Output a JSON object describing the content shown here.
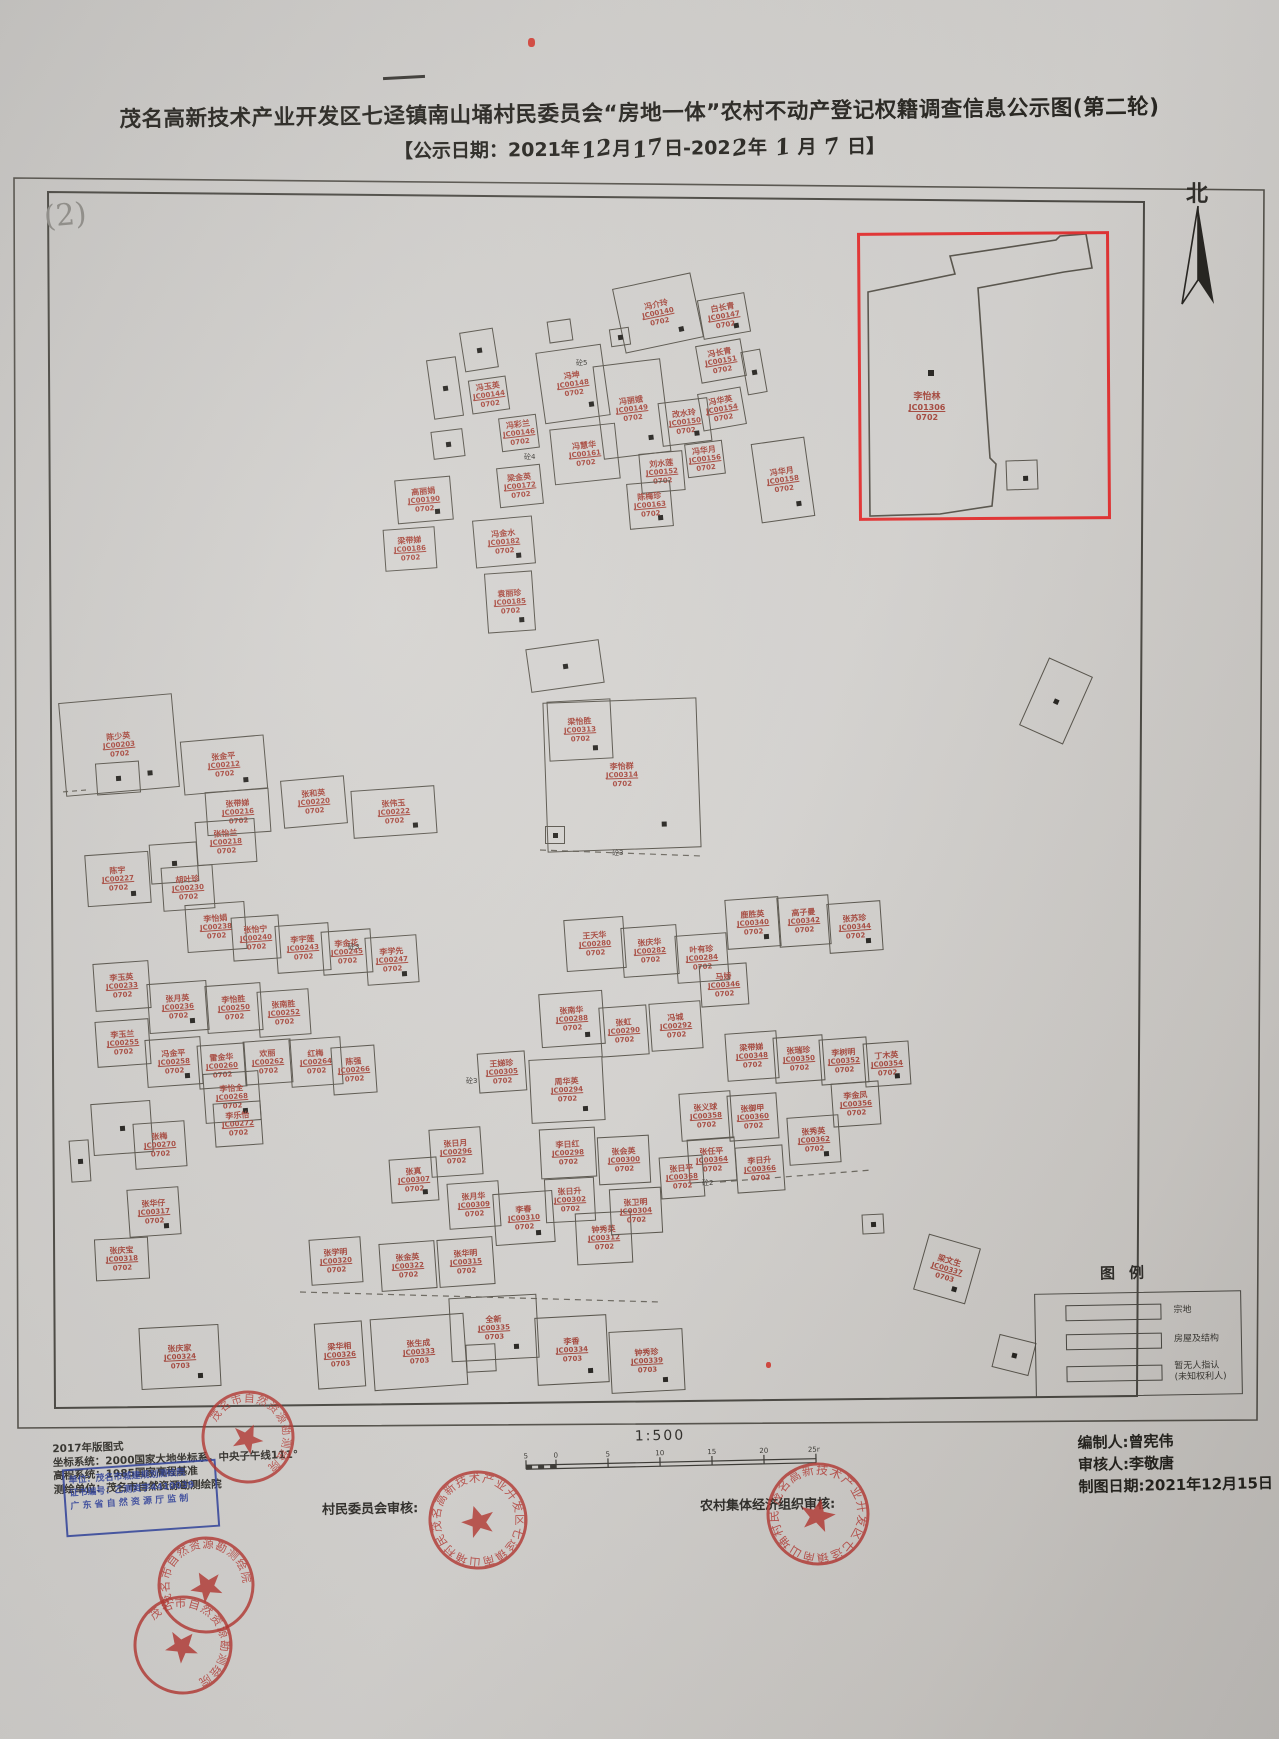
{
  "colors": {
    "paper": "#d2d0cd",
    "line_ink": "#514e47",
    "parcel_label_red": "#a8473c",
    "highlight_red": "#e83030",
    "stamp_red": "#b8342e",
    "stamp_blue": "#2c3f9e"
  },
  "title": {
    "line1": "茂名高新技术产业开发区七迳镇南山埇村民委员会“房地一体”农村不动产登记权籍调查信息公示图(第二轮)",
    "line2_parts": [
      {
        "t": "【公示日期：2021年"
      },
      {
        "t": "12",
        "hand": true
      },
      {
        "t": "月"
      },
      {
        "t": "17",
        "hand": true
      },
      {
        "t": "日-202"
      },
      {
        "t": "2",
        "hand": true
      },
      {
        "t": "年 "
      },
      {
        "t": "1",
        "hand": true
      },
      {
        "t": " 月 "
      },
      {
        "t": "7",
        "hand": true
      },
      {
        "t": " 日】"
      }
    ]
  },
  "annotations": {
    "page_number": "(2)",
    "north_label": "北",
    "sheet_marks": "handwritten dash and small red ink dots"
  },
  "legend": {
    "title": "图例",
    "items": [
      {
        "label": "宗地"
      },
      {
        "label": "房屋及结构"
      },
      {
        "label": "暂无人指认",
        "label2": "(未知权利人)"
      }
    ]
  },
  "scale": {
    "ratio": "1:500",
    "ticks": [
      "5",
      "0",
      "5",
      "10",
      "15",
      "20",
      "25m"
    ]
  },
  "footer": {
    "left_lines": [
      "2017年版图式",
      "坐标系统：2000国家大地坐标系，中央子午线111°",
      "高程系统：1985国家高程基准",
      "测绘单位：茂名市自然资源勘测绘院"
    ],
    "blue_stamp_lines": [
      "单位：茂名市城建规划测绘院",
      "证书编号：乙测资字4410039",
      "广 东 省 自 然 资 源 厅 监 制"
    ],
    "village_review_label": "村民委员会审核:",
    "collective_review_label": "农村集体经济组织审核:",
    "right_lines": [
      "编制人:曾宪伟",
      "审核人:李敬唐",
      "制图日期:2021年12月15日"
    ]
  },
  "stamps": [
    {
      "cx": 478,
      "cy": 1520,
      "r": 48,
      "rot": -18,
      "ring": "茂名高新技术产业开发区七迳镇南山埇村民委员会"
    },
    {
      "cx": 818,
      "cy": 1514,
      "r": 50,
      "rot": 12,
      "ring": "茂名高新技术产业开发区七迳镇南山埇村民委员会"
    },
    {
      "cx": 248,
      "cy": 1437,
      "r": 45,
      "rot": 25,
      "ring": "茂名市自然资源勘测绘院"
    },
    {
      "cx": 206,
      "cy": 1585,
      "r": 47,
      "rot": -30,
      "ring": "茂名市自然资源勘测绘院"
    },
    {
      "cx": 183,
      "cy": 1645,
      "r": 48,
      "rot": 40,
      "ring": "茂名市自然资源勘测绘院"
    }
  ],
  "map": {
    "buildings_format": "x,y,w,h,rotate_deg,owner_name,parcel_code,area_code,door_dot",
    "buildings": [
      [
        618,
        280,
        78,
        64,
        -12,
        "冯介玲",
        "JC00140",
        "0702",
        1
      ],
      [
        700,
        296,
        46,
        38,
        -10,
        "白长青",
        "JC00147",
        "0702",
        1
      ],
      [
        698,
        342,
        44,
        36,
        -10,
        "冯长青",
        "JC00151",
        "0702",
        0
      ],
      [
        744,
        350,
        18,
        42,
        -10,
        "",
        "",
        "",
        1
      ],
      [
        540,
        348,
        64,
        70,
        -8,
        "冯坤",
        "JC00148",
        "0702",
        1
      ],
      [
        598,
        362,
        66,
        92,
        -7,
        "冯丽娥",
        "JC00149",
        "0702",
        1
      ],
      [
        660,
        400,
        48,
        42,
        -7,
        "改水玲",
        "JC00150",
        "0702",
        1
      ],
      [
        552,
        426,
        64,
        54,
        -6,
        "冯慧华",
        "JC00161",
        "0702",
        0
      ],
      [
        640,
        452,
        42,
        38,
        -5,
        "刘水莲",
        "JC00152",
        "0702",
        0
      ],
      [
        700,
        390,
        42,
        36,
        -10,
        "冯华英",
        "JC00154",
        "0702",
        0
      ],
      [
        686,
        442,
        36,
        32,
        -7,
        "冯华月",
        "JC00156",
        "0702",
        0
      ],
      [
        628,
        482,
        42,
        44,
        -5,
        "陈梅珍",
        "JC00163",
        "0702",
        1
      ],
      [
        498,
        466,
        42,
        38,
        -6,
        "梁金英",
        "JC00172",
        "0702",
        0
      ],
      [
        396,
        478,
        54,
        42,
        -5,
        "高丽娟",
        "JC00190",
        "0702",
        1
      ],
      [
        474,
        518,
        58,
        46,
        -5,
        "冯金水",
        "JC00182",
        "0702",
        1
      ],
      [
        384,
        528,
        50,
        40,
        -4,
        "梁带娣",
        "JC00186",
        "0702",
        0
      ],
      [
        486,
        572,
        46,
        58,
        -4,
        "袁丽珍",
        "JC00185",
        "0702",
        1
      ],
      [
        430,
        358,
        28,
        58,
        -8,
        "",
        "",
        "",
        1
      ],
      [
        462,
        330,
        32,
        38,
        -9,
        "",
        "",
        "",
        1
      ],
      [
        470,
        378,
        36,
        32,
        -8,
        "冯玉英",
        "JC00144",
        "0702",
        0
      ],
      [
        432,
        430,
        30,
        26,
        -7,
        "",
        "",
        "",
        1
      ],
      [
        500,
        416,
        36,
        32,
        -7,
        "冯彩兰",
        "JC00146",
        "0702",
        0
      ],
      [
        548,
        320,
        22,
        20,
        -8,
        "",
        "",
        "",
        0
      ],
      [
        610,
        328,
        18,
        16,
        -8,
        "",
        "",
        "",
        1
      ],
      [
        756,
        440,
        52,
        78,
        -8,
        "冯华月",
        "JC00158",
        "0702",
        1
      ],
      [
        1032,
        664,
        46,
        72,
        24,
        "",
        "",
        "",
        1
      ],
      [
        545,
        700,
        152,
        148,
        -2,
        "李怡群",
        "JC00314",
        "0702",
        1
      ],
      [
        548,
        700,
        62,
        58,
        -3,
        "梁怡胜",
        "JC00313",
        "0702",
        1
      ],
      [
        545,
        826,
        18,
        16,
        0,
        "",
        "",
        "",
        1
      ],
      [
        528,
        644,
        72,
        42,
        -8,
        "",
        "",
        "",
        1
      ],
      [
        62,
        698,
        112,
        92,
        -5,
        "陈少英",
        "JC00203",
        "0702",
        1
      ],
      [
        96,
        762,
        42,
        30,
        -4,
        "",
        "",
        "",
        1
      ],
      [
        182,
        738,
        82,
        52,
        -5,
        "张金平",
        "JC00212",
        "0702",
        1
      ],
      [
        206,
        790,
        62,
        42,
        -4,
        "张带娣",
        "JC00216",
        "0702",
        0
      ],
      [
        282,
        778,
        62,
        46,
        -5,
        "张和英",
        "JC00220",
        "0702",
        0
      ],
      [
        352,
        788,
        82,
        46,
        -4,
        "张伟玉",
        "JC00222",
        "0702",
        1
      ],
      [
        196,
        820,
        58,
        42,
        -4,
        "张怡兰",
        "JC00218",
        "0702",
        0
      ],
      [
        150,
        843,
        46,
        38,
        -4,
        "",
        "",
        "",
        1
      ],
      [
        86,
        853,
        62,
        50,
        -4,
        "陈宇",
        "JC00227",
        "0702",
        1
      ],
      [
        162,
        866,
        50,
        42,
        -4,
        "胡叶珍",
        "JC00230",
        "0702",
        0
      ],
      [
        186,
        903,
        58,
        46,
        -4,
        "李怡娟",
        "JC00238",
        "0702",
        0
      ],
      [
        232,
        916,
        46,
        42,
        -4,
        "张怡宁",
        "JC00240",
        "0702",
        0
      ],
      [
        276,
        924,
        52,
        46,
        -4,
        "李宇莲",
        "JC00243",
        "0702",
        0
      ],
      [
        322,
        930,
        48,
        42,
        -4,
        "李金花",
        "JC00245",
        "0702",
        0
      ],
      [
        366,
        936,
        50,
        46,
        -4,
        "李学先",
        "JC00247",
        "0702",
        1
      ],
      [
        94,
        962,
        54,
        46,
        -4,
        "李玉英",
        "JC00233",
        "0702",
        0
      ],
      [
        148,
        982,
        58,
        48,
        -4,
        "张月英",
        "JC00236",
        "0702",
        1
      ],
      [
        206,
        984,
        54,
        46,
        -4,
        "李怡胜",
        "JC00250",
        "0702",
        0
      ],
      [
        258,
        990,
        50,
        44,
        -4,
        "张南胜",
        "JC00252",
        "0702",
        0
      ],
      [
        96,
        1020,
        52,
        44,
        -4,
        "李玉兰",
        "JC00255",
        "0702",
        0
      ],
      [
        146,
        1038,
        54,
        46,
        -4,
        "冯金平",
        "JC00258",
        "0702",
        1
      ],
      [
        198,
        1044,
        46,
        42,
        -4,
        "雷金华",
        "JC00260",
        "0702",
        0
      ],
      [
        244,
        1040,
        46,
        42,
        -4,
        "欢丽",
        "JC00262",
        "0702",
        0
      ],
      [
        290,
        1038,
        50,
        46,
        -4,
        "红梅",
        "JC00264",
        "0702",
        0
      ],
      [
        332,
        1046,
        42,
        46,
        -4,
        "陈强",
        "JC00266",
        "0702",
        0
      ],
      [
        204,
        1072,
        54,
        48,
        -4,
        "李怡全",
        "JC00268",
        "0702",
        1
      ],
      [
        92,
        1102,
        58,
        50,
        -4,
        "",
        "",
        "",
        1
      ],
      [
        70,
        1140,
        18,
        40,
        -4,
        "",
        "",
        "",
        1
      ],
      [
        134,
        1122,
        50,
        44,
        -4,
        "张梅",
        "JC00270",
        "0702",
        0
      ],
      [
        214,
        1102,
        46,
        42,
        -4,
        "李乐怡",
        "JC00272",
        "0702",
        0
      ],
      [
        128,
        1188,
        50,
        46,
        -4,
        "张华仔",
        "JC00317",
        "0702",
        1
      ],
      [
        95,
        1238,
        52,
        40,
        -3,
        "张庆宝",
        "JC00318",
        "0702",
        0
      ],
      [
        140,
        1326,
        78,
        60,
        -3,
        "张庆家",
        "JC00324",
        "0703",
        1
      ],
      [
        316,
        1322,
        46,
        64,
        -4,
        "梁华相",
        "JC00326",
        "0703",
        0
      ],
      [
        372,
        1316,
        92,
        70,
        -4,
        "张生成",
        "JC00333",
        "0703",
        0
      ],
      [
        466,
        1344,
        28,
        26,
        -3,
        "",
        "",
        "",
        0
      ],
      [
        450,
        1296,
        86,
        62,
        -3,
        "全新",
        "JC00335",
        "0703",
        1
      ],
      [
        536,
        1316,
        70,
        66,
        -3,
        "李香",
        "JC00334",
        "0703",
        1
      ],
      [
        610,
        1330,
        72,
        60,
        -3,
        "钟秀珍",
        "JC00339",
        "0703",
        1
      ],
      [
        565,
        918,
        58,
        50,
        -4,
        "王天华",
        "JC00280",
        "0702",
        0
      ],
      [
        622,
        926,
        54,
        48,
        -4,
        "张庆华",
        "JC00282",
        "0702",
        0
      ],
      [
        676,
        934,
        50,
        46,
        -4,
        "叶有珍",
        "JC00284",
        "0702",
        0
      ],
      [
        540,
        992,
        62,
        52,
        -4,
        "张南华",
        "JC00288",
        "0702",
        1
      ],
      [
        600,
        1006,
        46,
        48,
        -4,
        "张虹",
        "JC00290",
        "0702",
        0
      ],
      [
        650,
        1002,
        50,
        46,
        -4,
        "冯城",
        "JC00292",
        "0702",
        0
      ],
      [
        530,
        1058,
        72,
        62,
        -3,
        "周华英",
        "JC00294",
        "0702",
        1
      ],
      [
        478,
        1052,
        46,
        38,
        -4,
        "王娣珍",
        "JC00305",
        "0702",
        0
      ],
      [
        540,
        1128,
        54,
        48,
        -3,
        "李日红",
        "JC00298",
        "0702",
        0
      ],
      [
        598,
        1136,
        50,
        46,
        -3,
        "张会英",
        "JC00300",
        "0702",
        0
      ],
      [
        430,
        1128,
        50,
        46,
        -4,
        "张日月",
        "JC00296",
        "0702",
        0
      ],
      [
        390,
        1158,
        46,
        42,
        -4,
        "张真",
        "JC00307",
        "0702",
        1
      ],
      [
        448,
        1182,
        50,
        44,
        -4,
        "张月华",
        "JC00309",
        "0702",
        0
      ],
      [
        494,
        1192,
        58,
        50,
        -4,
        "李春",
        "JC00310",
        "0702",
        1
      ],
      [
        576,
        1212,
        54,
        50,
        -3,
        "钟秀英",
        "JC00312",
        "0702",
        0
      ],
      [
        545,
        1178,
        48,
        42,
        -3,
        "张日升",
        "JC00302",
        "0702",
        0
      ],
      [
        610,
        1188,
        50,
        44,
        -3,
        "张卫明",
        "JC00304",
        "0702",
        0
      ],
      [
        310,
        1238,
        50,
        44,
        -4,
        "张学明",
        "JC00320",
        "0702",
        0
      ],
      [
        380,
        1242,
        54,
        46,
        -4,
        "张金英",
        "JC00322",
        "0702",
        0
      ],
      [
        438,
        1238,
        54,
        46,
        -4,
        "张华明",
        "JC00315",
        "0702",
        0
      ],
      [
        726,
        898,
        52,
        48,
        -4,
        "鹿胜英",
        "JC00340",
        "0702",
        1
      ],
      [
        778,
        896,
        50,
        48,
        -4,
        "高子曼",
        "JC00342",
        "0702",
        0
      ],
      [
        828,
        902,
        52,
        48,
        -4,
        "张苏珍",
        "JC00344",
        "0702",
        1
      ],
      [
        700,
        964,
        46,
        40,
        -4,
        "马娇",
        "JC00346",
        "0702",
        0
      ],
      [
        726,
        1032,
        50,
        46,
        -4,
        "梁带娣",
        "JC00348",
        "0702",
        0
      ],
      [
        774,
        1036,
        48,
        44,
        -4,
        "张瑞珍",
        "JC00350",
        "0702",
        0
      ],
      [
        820,
        1038,
        46,
        44,
        -4,
        "李树明",
        "JC00352",
        "0702",
        0
      ],
      [
        864,
        1042,
        44,
        42,
        -4,
        "丁木英",
        "JC00354",
        "0702",
        1
      ],
      [
        832,
        1082,
        46,
        42,
        -4,
        "李金凤",
        "JC00356",
        "0702",
        0
      ],
      [
        680,
        1092,
        50,
        46,
        -4,
        "张义球",
        "JC00358",
        "0702",
        0
      ],
      [
        728,
        1094,
        48,
        44,
        -4,
        "张御甲",
        "JC00360",
        "0702",
        0
      ],
      [
        788,
        1116,
        50,
        46,
        -4,
        "张秀英",
        "JC00362",
        "0702",
        1
      ],
      [
        688,
        1138,
        46,
        42,
        -4,
        "张任平",
        "JC00364",
        "0702",
        0
      ],
      [
        736,
        1146,
        46,
        44,
        -4,
        "李日升",
        "JC00366",
        "0702",
        0
      ],
      [
        660,
        1156,
        42,
        40,
        -4,
        "张日平",
        "JC00368",
        "0702",
        0
      ],
      [
        862,
        1214,
        20,
        18,
        -3,
        "",
        "",
        "",
        1
      ],
      [
        995,
        1338,
        36,
        32,
        14,
        "",
        "",
        "",
        1
      ],
      [
        920,
        1240,
        52,
        56,
        16,
        "梁文生",
        "JC00337",
        "0703",
        1
      ]
    ],
    "big_parcel": {
      "points": "868,292 955,274 950,256 1056,240 1060,236 1086,234 1092,268 1064,272 978,288 990,458 996,464 992,506 940,514 870,516",
      "label": [
        "李怡林",
        "JC01306",
        "0702"
      ],
      "label_pos": [
        892,
        392
      ],
      "annex": [
        1006,
        460,
        30,
        28
      ],
      "dot": [
        928,
        370
      ]
    },
    "concrete_marks": [
      [
        576,
        358,
        "砼5"
      ],
      [
        524,
        452,
        "砼4"
      ],
      [
        612,
        848,
        "砼3"
      ],
      [
        466,
        1076,
        "砼3"
      ],
      [
        702,
        1178,
        "砼2"
      ],
      [
        348,
        942,
        "砼3"
      ]
    ],
    "red_ink_dots": [
      [
        528,
        38,
        7,
        9
      ],
      [
        766,
        1362,
        5,
        6
      ]
    ]
  }
}
